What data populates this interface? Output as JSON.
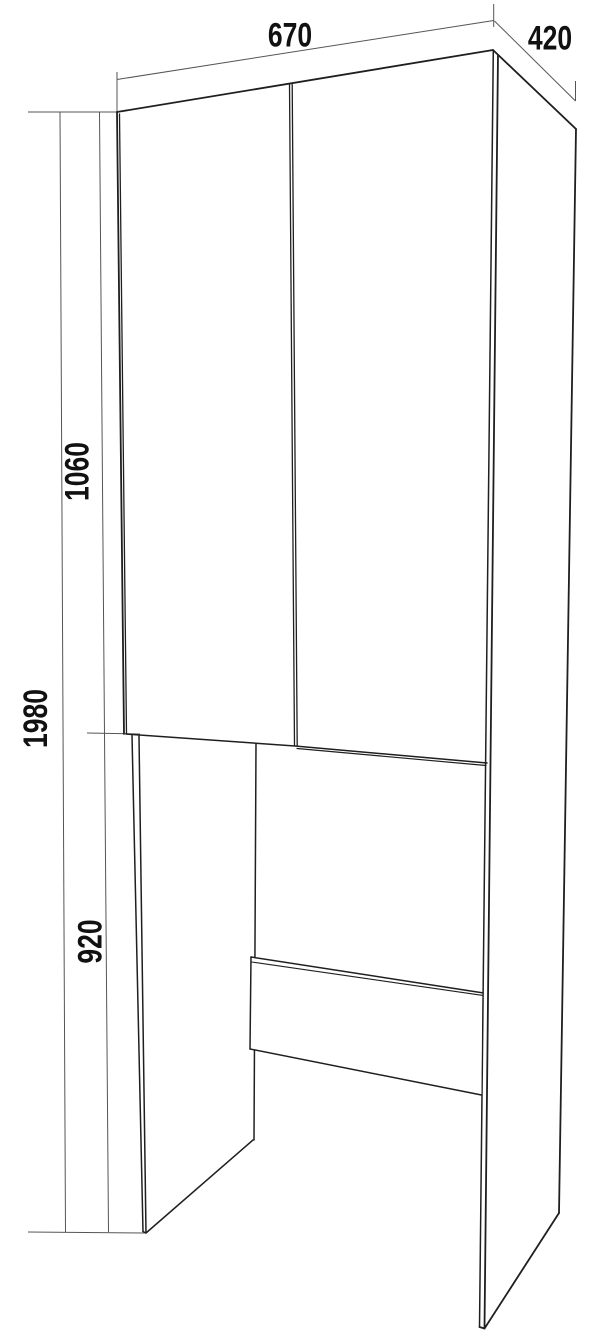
{
  "drawing": {
    "labels": {
      "width": "670",
      "depth": "420",
      "upper_height": "1060",
      "total_height": "1980",
      "niche_height": "920"
    },
    "colors": {
      "background": "#ffffff",
      "edge": "#1f1f1f",
      "dimension": "#555555",
      "label": "#111111"
    }
  }
}
